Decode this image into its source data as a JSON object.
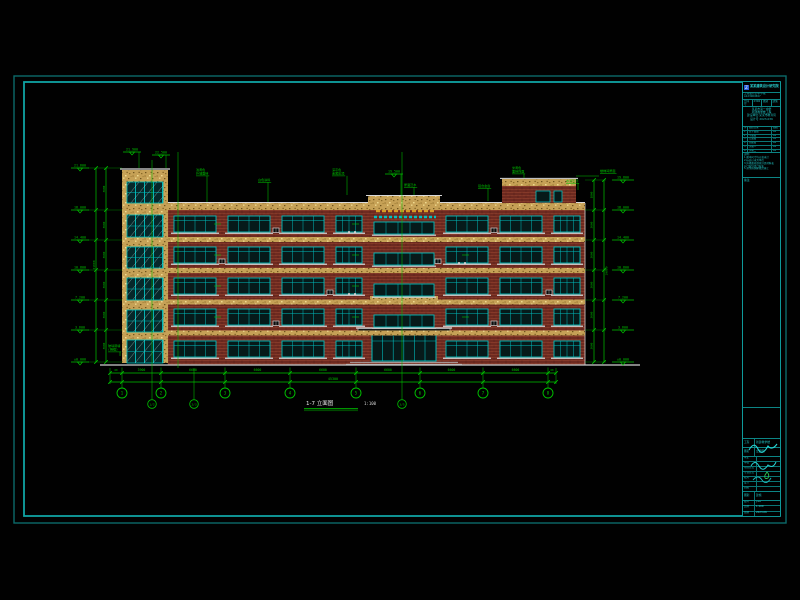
{
  "drawing_title": {
    "name": "1-7 立面图",
    "scale": "1:100"
  },
  "palette": {
    "frame_outer": "#0b6a6a",
    "frame_inner": "#0fa3a3",
    "annotation_green": "#00c400",
    "brick_red": "#6e2a20",
    "band_tan": "#c6a156",
    "window_cyan": "#00bcbc",
    "detail_white": "#d9d9d9",
    "sign_orange": "#d89c28"
  },
  "levels_left": [
    "21.600",
    "18.000",
    "14.400",
    "10.800",
    "7.200",
    "3.600",
    "±0.000"
  ],
  "levels_right": [
    "19.800",
    "18.000",
    "14.400",
    "10.800",
    "7.200",
    "3.600",
    "±0.000"
  ],
  "tower_top_levels": [
    "21.900",
    "22.500"
  ],
  "central_top_level": "19.500",
  "vertical_dims_left": {
    "segments": [
      "3600",
      "3600",
      "3600",
      "3600",
      "3600",
      "3600"
    ],
    "total": "21600"
  },
  "vertical_dims_right": {
    "segments": [
      "1800",
      "3600",
      "3600",
      "3600",
      "3600",
      "3600"
    ],
    "total": "19800"
  },
  "horizontal_dims": {
    "end_offsets": [
      "60",
      "60"
    ],
    "segments": [
      "3900",
      "6600",
      "6600",
      "6600",
      "6600",
      "6600",
      "6600"
    ],
    "total": "45300"
  },
  "grid_bubbles": [
    "1",
    "2",
    "3",
    "4",
    "5",
    "6",
    "7",
    "8"
  ],
  "secondary_bubbles": [
    "1/2",
    "2/3",
    "3/5"
  ],
  "material_labels": [
    {
      "lines": [
        "浅黄色",
        "外墙面砖"
      ]
    },
    {
      "lines": [
        "白色涂料"
      ]
    },
    {
      "lines": [
        "深灰色",
        "金属压顶"
      ]
    },
    {
      "lines": [
        "屋面泛水"
      ]
    },
    {
      "lines": [
        "铝合金窗"
      ]
    },
    {
      "lines": [
        "米黄色",
        "面砖饰面"
      ]
    },
    {
      "lines": [
        "水泥压顶"
      ]
    },
    {
      "lines": [
        "楼梯间屋面"
      ]
    },
    {
      "lines": [
        "玻璃幕墙",
        "(明框)"
      ]
    }
  ],
  "title_block": {
    "header_name": "某某建筑设计研究院",
    "header_cert": "工程设计证书 甲级 A123004567",
    "cells": [
      "合同号",
      "2306",
      "图别",
      "建施"
    ],
    "project_lines": [
      "某某市第一中学",
      "新建教学楼工程",
      "建设单位:某某市教育局",
      "设计号 2023-036"
    ],
    "sheet_table_header": [
      "序",
      "图纸目录",
      "图幅"
    ],
    "sheet_table": [
      [
        "1",
        "总平面图",
        "A2"
      ],
      [
        "2",
        "平面图",
        "A2"
      ],
      [
        "3",
        "立面图",
        "A2"
      ],
      [
        "4",
        "剖面图",
        "A2"
      ],
      [
        "5",
        "详图一",
        "A2"
      ],
      [
        "6",
        "详图二",
        "A2"
      ],
      [
        "7",
        "门窗表",
        "A2"
      ],
      [
        "8",
        "节点详图",
        "A2"
      ]
    ],
    "notes_title": "说明:",
    "notes": [
      "1.图中尺寸均以毫米计",
      "2.标高以米为单位",
      "3.外墙面砖颜色详见材料表",
      "4.门窗详见门窗表",
      "5.其余按国家规范施工"
    ],
    "box1_label": "备注",
    "rows2": [
      [
        "工程",
        "新建教学楼"
      ],
      [
        "图名",
        "立面图"
      ]
    ],
    "sign_rows": [
      "审定",
      "审核",
      "项目负责",
      "专业负责",
      "校对",
      "设计",
      "制图"
    ],
    "fig_row": [
      "图别",
      "建施"
    ],
    "grid_rows": [
      [
        "图号",
        "J-06"
      ],
      [
        "比例",
        "1:100"
      ],
      [
        "日期",
        "2023.06"
      ]
    ]
  }
}
